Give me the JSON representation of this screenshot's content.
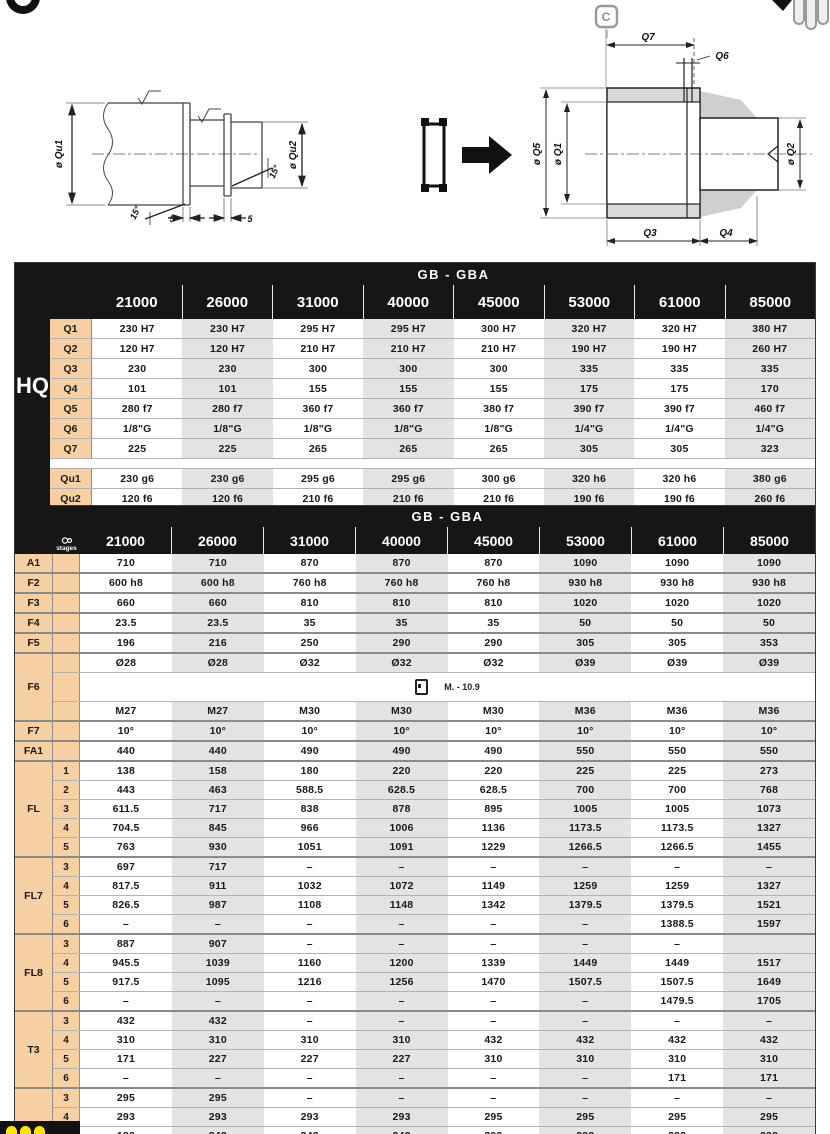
{
  "colors": {
    "header_bg": "#161616",
    "row_label_bg": "#f6cfa2",
    "band": "#e3e3e3",
    "accent_yellow": "#ffe400"
  },
  "diagrams": {
    "left": {
      "dia_qu1": "ø Qu1",
      "dia_qu2": "ø Qu2",
      "angle1": "15°",
      "angle2": "15°",
      "dim1": "5",
      "dim2": "5"
    },
    "right": {
      "badge": "C",
      "q7": "Q7",
      "q6": "Q6",
      "dia_q5": "ø Q5",
      "dia_q1": "ø Q1",
      "dia_q2": "ø Q2",
      "q3": "Q3",
      "q4": "Q4"
    }
  },
  "table1": {
    "title": "GB - GBA",
    "group_label": "HQ",
    "columns": [
      "21000",
      "26000",
      "31000",
      "40000",
      "45000",
      "53000",
      "61000",
      "85000"
    ],
    "rows": [
      {
        "label": "Q1",
        "values": [
          "230 H7",
          "230 H7",
          "295 H7",
          "295 H7",
          "300 H7",
          "320 H7",
          "320 H7",
          "380 H7"
        ]
      },
      {
        "label": "Q2",
        "values": [
          "120 H7",
          "120 H7",
          "210 H7",
          "210 H7",
          "210 H7",
          "190 H7",
          "190 H7",
          "260 H7"
        ]
      },
      {
        "label": "Q3",
        "values": [
          "230",
          "230",
          "300",
          "300",
          "300",
          "335",
          "335",
          "335"
        ]
      },
      {
        "label": "Q4",
        "values": [
          "101",
          "101",
          "155",
          "155",
          "155",
          "175",
          "175",
          "170"
        ]
      },
      {
        "label": "Q5",
        "values": [
          "280 f7",
          "280 f7",
          "360 f7",
          "360 f7",
          "380 f7",
          "390 f7",
          "390 f7",
          "460 f7"
        ]
      },
      {
        "label": "Q6",
        "values": [
          "1/8\"G",
          "1/8\"G",
          "1/8\"G",
          "1/8\"G",
          "1/8\"G",
          "1/4\"G",
          "1/4\"G",
          "1/4\"G"
        ]
      },
      {
        "label": "Q7",
        "values": [
          "225",
          "225",
          "265",
          "265",
          "265",
          "305",
          "305",
          "323"
        ]
      },
      {
        "spacer": true
      },
      {
        "label": "Qu1",
        "values": [
          "230 g6",
          "230 g6",
          "295 g6",
          "295 g6",
          "300 g6",
          "320 h6",
          "320 h6",
          "380 g6"
        ]
      },
      {
        "label": "Qu2",
        "values": [
          "120 f6",
          "120 f6",
          "210 f6",
          "210 f6",
          "210 f6",
          "190 f6",
          "190 f6",
          "260 f6"
        ]
      }
    ]
  },
  "table2": {
    "title": "GB - GBA",
    "stages_label": "stages",
    "columns": [
      "21000",
      "26000",
      "31000",
      "40000",
      "45000",
      "53000",
      "61000",
      "85000"
    ],
    "groups": [
      {
        "label": "A1",
        "rows": [
          {
            "stage": "",
            "values": [
              "710",
              "710",
              "870",
              "870",
              "870",
              "1090",
              "1090",
              "1090"
            ]
          }
        ]
      },
      {
        "label": "F2",
        "rows": [
          {
            "stage": "",
            "values": [
              "600 h8",
              "600 h8",
              "760 h8",
              "760 h8",
              "760 h8",
              "930 h8",
              "930 h8",
              "930 h8"
            ]
          }
        ]
      },
      {
        "label": "F3",
        "rows": [
          {
            "stage": "",
            "values": [
              "660",
              "660",
              "810",
              "810",
              "810",
              "1020",
              "1020",
              "1020"
            ]
          }
        ]
      },
      {
        "label": "F4",
        "rows": [
          {
            "stage": "",
            "values": [
              "23.5",
              "23.5",
              "35",
              "35",
              "35",
              "50",
              "50",
              "50"
            ]
          }
        ]
      },
      {
        "label": "F5",
        "rows": [
          {
            "stage": "",
            "values": [
              "196",
              "216",
              "250",
              "290",
              "290",
              "305",
              "305",
              "353"
            ]
          }
        ]
      },
      {
        "label": "F6",
        "rows": [
          {
            "stage": "",
            "values": [
              "Ø28",
              "Ø28",
              "Ø32",
              "Ø32",
              "Ø32",
              "Ø39",
              "Ø39",
              "Ø39"
            ]
          },
          {
            "stage": "",
            "span": "M. - 10.9",
            "icon": "bolt-icon"
          },
          {
            "stage": "",
            "values": [
              "M27",
              "M27",
              "M30",
              "M30",
              "M30",
              "M36",
              "M36",
              "M36"
            ]
          }
        ]
      },
      {
        "label": "F7",
        "rows": [
          {
            "stage": "",
            "values": [
              "10°",
              "10°",
              "10°",
              "10°",
              "10°",
              "10°",
              "10°",
              "10°"
            ]
          }
        ]
      },
      {
        "label": "FA1",
        "rows": [
          {
            "stage": "",
            "values": [
              "440",
              "440",
              "490",
              "490",
              "490",
              "550",
              "550",
              "550"
            ]
          }
        ]
      },
      {
        "label": "FL",
        "rows": [
          {
            "stage": "1",
            "values": [
              "138",
              "158",
              "180",
              "220",
              "220",
              "225",
              "225",
              "273"
            ]
          },
          {
            "stage": "2",
            "values": [
              "443",
              "463",
              "588.5",
              "628.5",
              "628.5",
              "700",
              "700",
              "768"
            ]
          },
          {
            "stage": "3",
            "values": [
              "611.5",
              "717",
              "838",
              "878",
              "895",
              "1005",
              "1005",
              "1073"
            ]
          },
          {
            "stage": "4",
            "values": [
              "704.5",
              "845",
              "966",
              "1006",
              "1136",
              "1173.5",
              "1173.5",
              "1327"
            ]
          },
          {
            "stage": "5",
            "values": [
              "763",
              "930",
              "1051",
              "1091",
              "1229",
              "1266.5",
              "1266.5",
              "1455"
            ]
          }
        ]
      },
      {
        "label": "FL7",
        "rows": [
          {
            "stage": "3",
            "values": [
              "697",
              "717",
              "–",
              "–",
              "–",
              "–",
              "–",
              "–"
            ]
          },
          {
            "stage": "4",
            "values": [
              "817.5",
              "911",
              "1032",
              "1072",
              "1149",
              "1259",
              "1259",
              "1327"
            ]
          },
          {
            "stage": "5",
            "values": [
              "826.5",
              "987",
              "1108",
              "1148",
              "1342",
              "1379.5",
              "1379.5",
              "1521"
            ]
          },
          {
            "stage": "6",
            "values": [
              "–",
              "–",
              "–",
              "–",
              "–",
              "–",
              "1388.5",
              "1597"
            ]
          }
        ]
      },
      {
        "label": "FL8",
        "rows": [
          {
            "stage": "3",
            "values": [
              "887",
              "907",
              "–",
              "–",
              "–",
              "–",
              "–",
              ""
            ]
          },
          {
            "stage": "4",
            "values": [
              "945.5",
              "1039",
              "1160",
              "1200",
              "1339",
              "1449",
              "1449",
              "1517"
            ]
          },
          {
            "stage": "5",
            "values": [
              "917.5",
              "1095",
              "1216",
              "1256",
              "1470",
              "1507.5",
              "1507.5",
              "1649"
            ]
          },
          {
            "stage": "6",
            "values": [
              "–",
              "–",
              "–",
              "–",
              "–",
              "–",
              "1479.5",
              "1705"
            ]
          }
        ]
      },
      {
        "label": "T3",
        "rows": [
          {
            "stage": "3",
            "values": [
              "432",
              "432",
              "–",
              "–",
              "–",
              "–",
              "–",
              "–"
            ]
          },
          {
            "stage": "4",
            "values": [
              "310",
              "310",
              "310",
              "310",
              "432",
              "432",
              "432",
              "432"
            ]
          },
          {
            "stage": "5",
            "values": [
              "171",
              "227",
              "227",
              "227",
              "310",
              "310",
              "310",
              "310"
            ]
          },
          {
            "stage": "6",
            "values": [
              "–",
              "–",
              "–",
              "–",
              "–",
              "–",
              "171",
              "171"
            ]
          }
        ]
      },
      {
        "label": "T4",
        "rows": [
          {
            "stage": "3",
            "values": [
              "295",
              "295",
              "–",
              "–",
              "–",
              "–",
              "–",
              "–"
            ]
          },
          {
            "stage": "4",
            "values": [
              "293",
              "293",
              "293",
              "293",
              "295",
              "295",
              "295",
              "295"
            ]
          },
          {
            "stage": "5",
            "values": [
              "183",
              "242",
              "242",
              "242",
              "293",
              "293",
              "293",
              "293"
            ]
          },
          {
            "stage": "6",
            "values": [
              "–",
              "–",
              "–",
              "–",
              "–",
              "–",
              "183",
              "183"
            ]
          }
        ]
      }
    ]
  }
}
